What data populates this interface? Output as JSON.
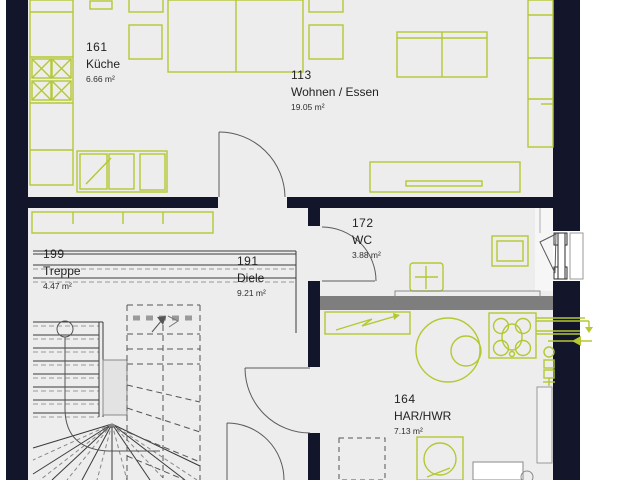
{
  "plan_title": "Erdgeschoss Grundriss",
  "colors": {
    "furniture_green": "#b5c832",
    "wall_dark": "#13152b",
    "wall_gray": "#7e7e7e",
    "floor_gray": "#ededed",
    "line_gray": "#555555",
    "text": "#232323"
  },
  "rooms": [
    {
      "id": "161",
      "name": "Küche",
      "area": "6.66 m²"
    },
    {
      "id": "113",
      "name": "Wohnen / Essen",
      "area": "19.05 m²"
    },
    {
      "id": "172",
      "name": "WC",
      "area": "3.88 m²"
    },
    {
      "id": "199",
      "name": "Treppe",
      "area": "4.47 m²"
    },
    {
      "id": "191",
      "name": "Diele",
      "area": "9.21 m²"
    },
    {
      "id": "164",
      "name": "HAR/HWR",
      "area": "7.13 m²"
    }
  ]
}
